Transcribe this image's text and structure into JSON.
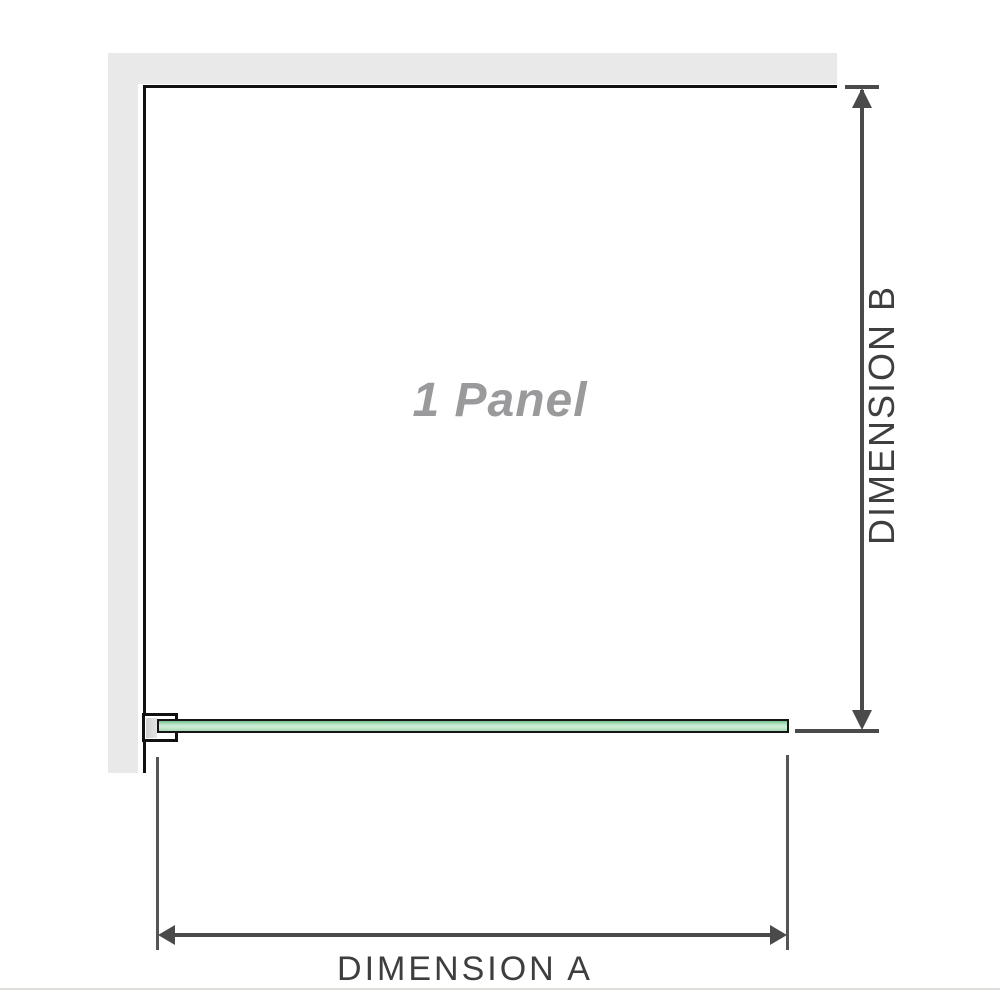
{
  "diagram": {
    "type": "shower-screen-panel-dimension-diagram",
    "panel_label": "1 Panel",
    "dimension_a_label": "DIMENSION A",
    "dimension_b_label": "DIMENSION B"
  },
  "colors": {
    "wall": "#e9e9e9",
    "panel_outline": "#111111",
    "glass_green_dark": "#72bf8a",
    "glass_green_mid": "#b7e2c3",
    "glass_green_light": "#d2eeda",
    "dimension_line": "#4a4a4a",
    "dimension_text": "#3e3e3e",
    "panel_label_text": "#9a9a9c",
    "bracket_anchor": "#d8d8d8",
    "footer_line": "#e0ded9"
  }
}
